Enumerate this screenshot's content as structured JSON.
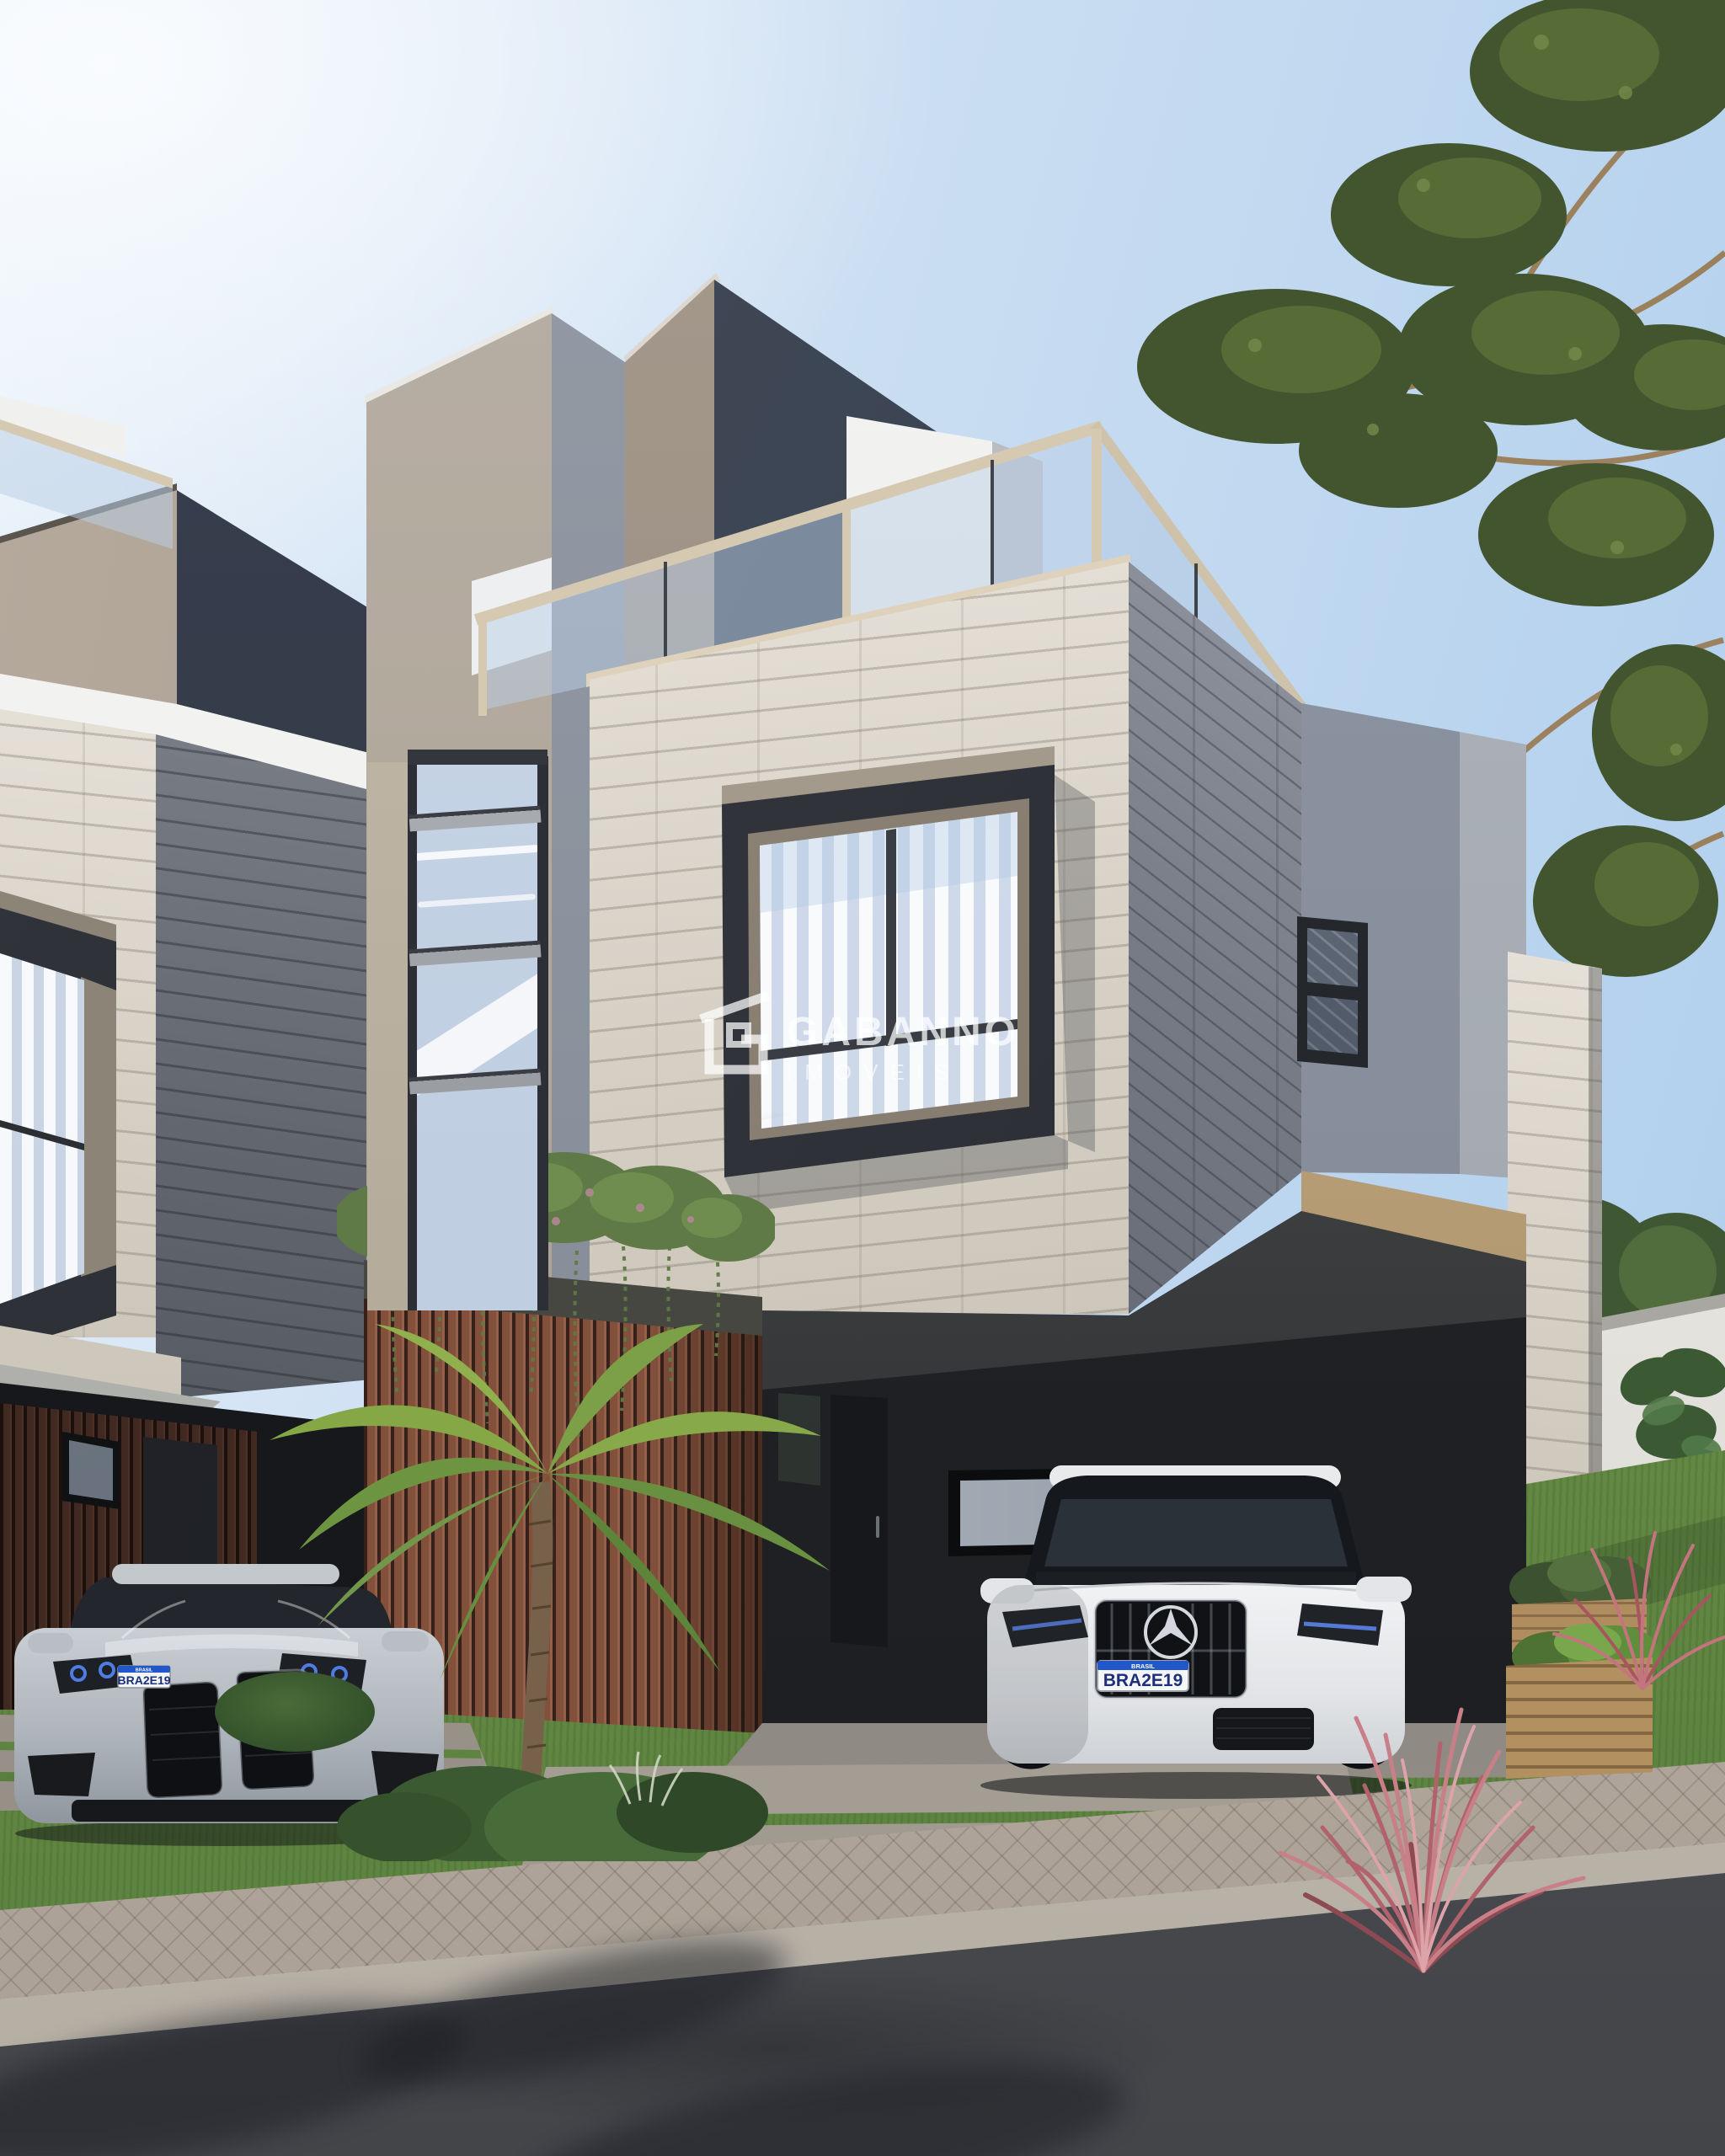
{
  "image": {
    "kind": "3d-architectural-exterior-render",
    "subject": "modern multi-storey townhouses with travertine stone facades, rooftop glass-railing terrace, wood-slat garage walls, carport and landscaped front yard",
    "sky": "clear blue, brightest at upper left",
    "vegetation": [
      "araucaria pine branches upper right",
      "palm tree at driveway",
      "hanging planter vines over garage",
      "pink ornamental grasses",
      "raised wooden planter boxes",
      "lawn with concrete stepping slabs"
    ]
  },
  "watermark": {
    "brand": "GABANNO",
    "subtitle": "IMÓVEIS",
    "logo": "gabanno-house-monogram-logo",
    "color": "#ffffff"
  },
  "vehicles": [
    {
      "name": "white-mercedes-suv",
      "location": "under carport",
      "plate_band": "BRASIL",
      "plate": "BRA2E19"
    },
    {
      "name": "silver-bmw-coupe",
      "location": "left driveway",
      "plate_band": "BRASIL",
      "plate": "BRA2E19"
    }
  ],
  "palette": {
    "sky_top_right": "#adcdec",
    "sky_top_left": "#f7fafc",
    "taupe_panel": "#b3a79a",
    "dark_navy_panel": "#343b4c",
    "slate_side": "#3f4856",
    "stone_lit": "#ddd7cd",
    "stone_shaded": "#7b7f88",
    "white_fascia": "#eff0ee",
    "railing_frame_cream": "#d6c9b2",
    "glass_blue": "#c4d2e4",
    "wood_slats_main": "#83503c",
    "wood_slats_dark": "#402921",
    "carport_interior": "#232528",
    "carport_fascia_beige": "#c2a87f",
    "lawn_green": "#6b8f47",
    "asphalt": "#4c4e53",
    "paver_sidewalk": "#b5aba0",
    "pink_grass": "#c47d86",
    "planter_wood": "#b08d5f",
    "white_garden_wall": "#e9e7e2"
  }
}
